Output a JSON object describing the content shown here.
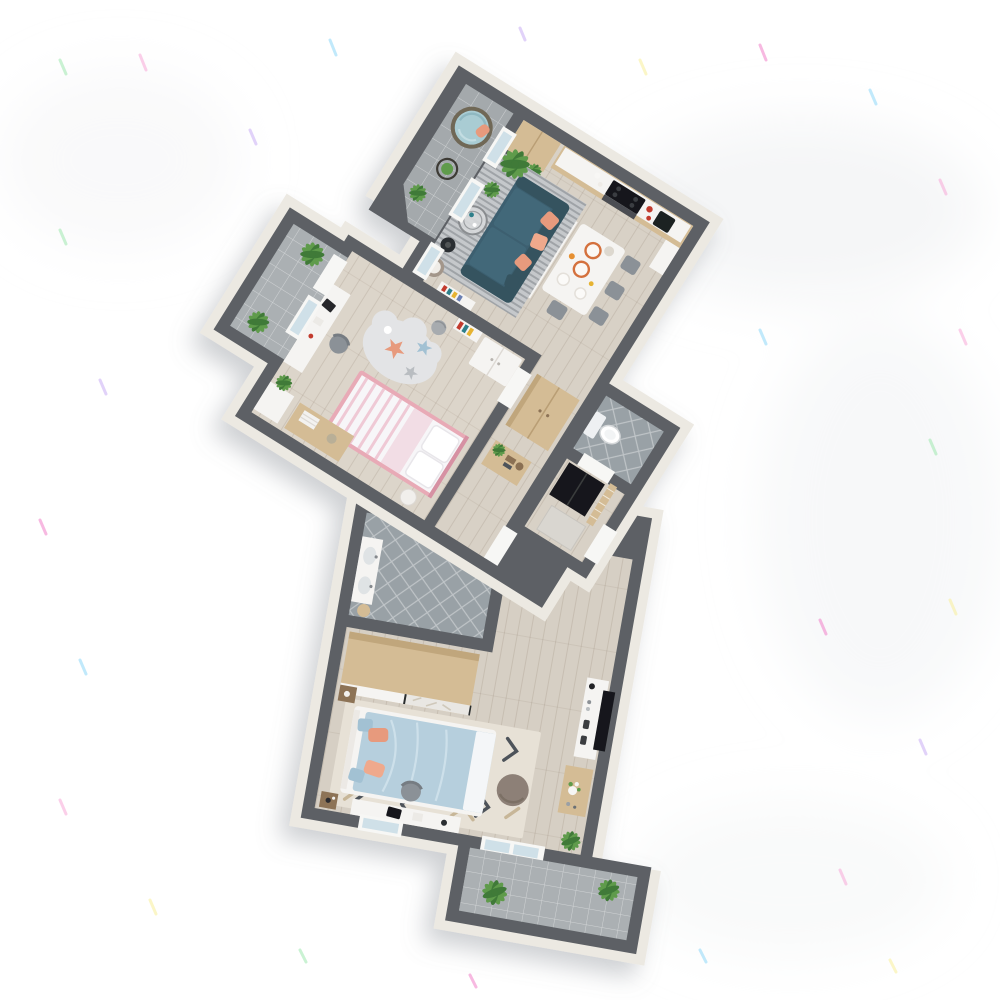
{
  "scene": {
    "kind": "3d-floor-plan-render",
    "view": "isometric-top-down",
    "background": "#ffffff",
    "shadow": "soft shadow to lower-left of building"
  },
  "palette": {
    "wall": "#5d6165",
    "band": "#ece9e2",
    "wood1": "#d8d1c6",
    "wood2": "#dcd5ca",
    "wood3": "#d6cfc4",
    "tileA": "#a4a9ac",
    "tileB": "#99a1a6",
    "tileC": "#abb0b3",
    "sofa": "#3c5f6f",
    "sofaDk": "#34535f",
    "sofaSeat": "#426879",
    "coral": "#e79a7d",
    "coral2": "#efa98c",
    "duvet": "#b6cfdd",
    "pillowBlue": "#a2c1d3",
    "childFrame": "#e8aab6",
    "childStripe": "#efc9d5",
    "cloud": "#e3e4e6",
    "rugLiv": "#c5c8cb",
    "rug2": "#e7e1d6",
    "rug2dark": "#4e535a",
    "rug2tan": "#c7b698",
    "wood": "#d4bc95",
    "woodDk": "#8d7356",
    "woodSide": "#c0a67c",
    "white": "#f5f4f2",
    "black": "#17191b",
    "chair": "#8b9197",
    "drum": "#a3968a",
    "pouf": "#8d8077",
    "plant": "#5f9b4c",
    "plantDk": "#3f7a38",
    "teal": "#2e7f8a",
    "red": "#c23b2e",
    "glass": "#cfe0e8",
    "doorW": "#f7f7f5",
    "mirror": "#e9e7e3",
    "metal": "#53575a",
    "basket": "#a7abaf",
    "toilet": "#eef0f2",
    "sp1": "#f7a8d8",
    "sp2": "#8fd8f8",
    "sp3": "#f8ef9a",
    "sp4": "#c9aef5",
    "sp5": "#9fe8b0",
    "sp6": "#f080c8"
  },
  "rooms": [
    {
      "id": "entry-balcony",
      "floor": "grey tile",
      "items": [
        "papasan chair with light-blue cushion",
        "wire side table with plant",
        "potted plant"
      ]
    },
    {
      "id": "kitchen",
      "floor": "light wood",
      "items": [
        "wood counter with white top",
        "black cooktop",
        "oven",
        "coffee machine",
        "tall wood cabinet",
        "metal shelf with teal box",
        "white fridge cabinet",
        "red kettle"
      ]
    },
    {
      "id": "living-dining",
      "floor": "light wood",
      "items": [
        "dark teal sofa with coral pillows",
        "grey striped rug",
        "round glass coffee table",
        "black floor lamp",
        "drum side table",
        "white console",
        "white dining table with plates",
        "4 grey chairs",
        "palm plant",
        "potted plant",
        "low white bookshelf"
      ]
    },
    {
      "id": "child-bedroom",
      "floor": "light wood",
      "items": [
        "pink and white single bed",
        "white desk with chair and laptop",
        "cloud rug with star cushions",
        "white shelf",
        "white wardrobe",
        "grey basket",
        "wood dresser with towels",
        "plant"
      ]
    },
    {
      "id": "child-balcony",
      "floor": "grey tile",
      "items": [
        "palm plant",
        "palm plant"
      ]
    },
    {
      "id": "hallway",
      "floor": "light wood",
      "items": [
        "tall wood wardrobe",
        "wood sideboard with plant and books"
      ]
    },
    {
      "id": "wc",
      "floor": "grey diamond tile",
      "items": [
        "toilet"
      ]
    },
    {
      "id": "entry",
      "floor": "light wood",
      "items": [
        "black coat closet",
        "wood slat screen",
        "doormat",
        "entrance door"
      ]
    },
    {
      "id": "bathroom",
      "floor": "grey diamond tile",
      "items": [
        "white vanity with two sinks",
        "towel rail with towel",
        "wood stool"
      ]
    },
    {
      "id": "master-bedroom",
      "floor": "light wood",
      "items": [
        "sliding-door wardrobe white and mirror",
        "double bed with light-blue duvet and coral pillows",
        "geometric cream rug",
        "two dark wood nightstands",
        "white TV cabinet with black TV",
        "wood console with white flowers",
        "grey pouf",
        "white desk with chair and laptop",
        "plant"
      ]
    },
    {
      "id": "master-balcony",
      "floor": "grey tile",
      "items": [
        "palm plant",
        "palm plant"
      ]
    }
  ],
  "counts": {
    "dining_chairs": 4,
    "sofa_pillows": 4,
    "master_bed_pillows": 4,
    "balconies": 3
  },
  "speckles": {
    "description": "scattered colorful noise streaks on white background",
    "colors": [
      "#f7a8d8",
      "#8fd8f8",
      "#f8ef9a",
      "#c9aef5",
      "#9fe8b0",
      "#f080c8"
    ]
  }
}
